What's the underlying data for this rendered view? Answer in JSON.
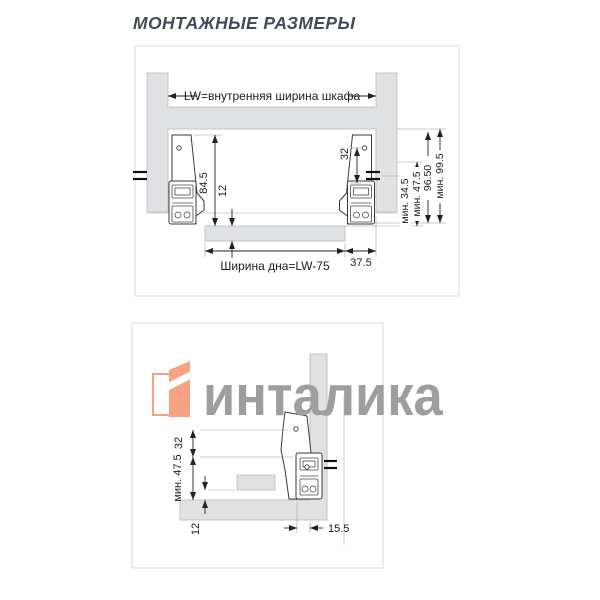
{
  "title": "МОНТАЖНЫЕ РАЗМЕРЫ",
  "watermark": {
    "brand": "инталика"
  },
  "colors": {
    "accent_orange": "#F7A285",
    "watermark_gray": "#9E9E9E",
    "panel_gray": "#DFE1E3",
    "line_dark": "#222222",
    "title_color": "#414B59"
  },
  "top_diagram": {
    "inner_width_label": "LW=внутренняя ширина шкафа",
    "bottom_width_label": "Ширина дна=LW-75",
    "dim_84_5": "84.5",
    "dim_12": "12",
    "dim_32": "32",
    "dim_37_5": "37.5",
    "dim_min_34_5": "мин. 34.5",
    "dim_min_47_5": "мин. 47.5",
    "dim_96_50": "96.50",
    "dim_min_99_5": "мин. 99.5"
  },
  "bottom_diagram": {
    "dim_32": "32",
    "dim_min_47_5": "мин. 47.5",
    "dim_12": "12",
    "dim_15_5": "15.5"
  }
}
